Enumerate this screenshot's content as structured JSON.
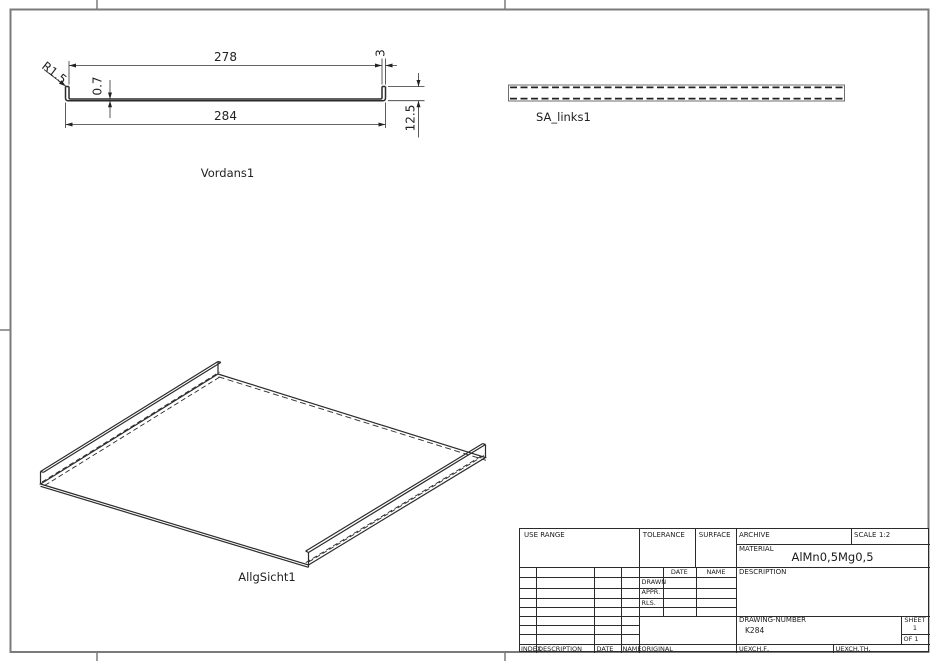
{
  "drawing": {
    "frame_color": "#7b7b7b",
    "line_color": "#2b2b2b",
    "views": {
      "front_view": {
        "label": "Vordans1",
        "dim_width_inner": "278",
        "dim_flange_width": "3",
        "dim_width_outer": "284",
        "dim_thickness": "0.7",
        "dim_height": "12.5",
        "dim_radius": "R1.5"
      },
      "side_view": {
        "label": "SA_links1"
      },
      "iso_view": {
        "label": "AllgSicht1"
      }
    },
    "dimensions_mm": {
      "outer_width": 284,
      "inner_width": 278,
      "flange_width": 3,
      "sheet_thickness": 0.7,
      "flange_height": 12.5,
      "bend_radius": 1.5
    }
  },
  "title_block": {
    "use_range_label": "USE RANGE",
    "tolerance_label": "TOLERANCE",
    "surface_label": "SURFACE",
    "archive_label": "ARCHIVE",
    "scale_label": "SCALE",
    "scale_value": "1:2",
    "material_label": "MATERIAL",
    "material_value": "AlMn0,5Mg0,5",
    "date_label": "DATE",
    "name_label": "NAME",
    "drawn_label": "DRAWN",
    "appr_label": "APPR.",
    "rls_label": "RLS.",
    "description_label": "DESCRIPTION",
    "drawing_number_label": "DRAWING-NUMBER",
    "drawing_number_value": "K284",
    "sheet_label": "SHEET",
    "sheet_value": "1",
    "of_value": "OF 1",
    "footer": {
      "index_label": "INDEX",
      "description_label": "DESCRIPTION",
      "date_label": "DATE",
      "name_label": "NAME",
      "original_label": "ORIGINAL",
      "uexch_f_label": "UEXCH.F,",
      "uexch_th_label": "UEXCH.TH,"
    }
  }
}
